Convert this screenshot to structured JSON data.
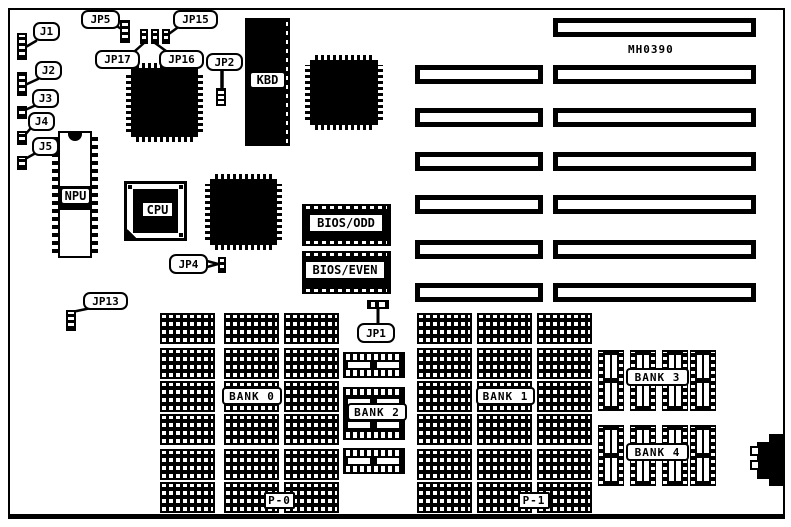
{
  "board": {
    "part_number": "MH0390"
  },
  "jumpers": {
    "j1": "J1",
    "j2": "J2",
    "j3": "J3",
    "j4": "J4",
    "j5": "J5",
    "jp1": "JP1",
    "jp2": "JP2",
    "jp4": "JP4",
    "jp5": "JP5",
    "jp13": "JP13",
    "jp15": "JP15",
    "jp16": "JP16",
    "jp17": "JP17"
  },
  "chips": {
    "kbd": "KBD",
    "npu": "NPU",
    "cpu": "CPU",
    "bios_odd": "BIOS/ODD",
    "bios_even": "BIOS/EVEN"
  },
  "memory": {
    "bank0": "BANK 0",
    "bank1": "BANK 1",
    "bank2": "BANK 2",
    "bank3": "BANK 3",
    "bank4": "BANK 4",
    "p0": "P-0",
    "p1": "P-1"
  }
}
